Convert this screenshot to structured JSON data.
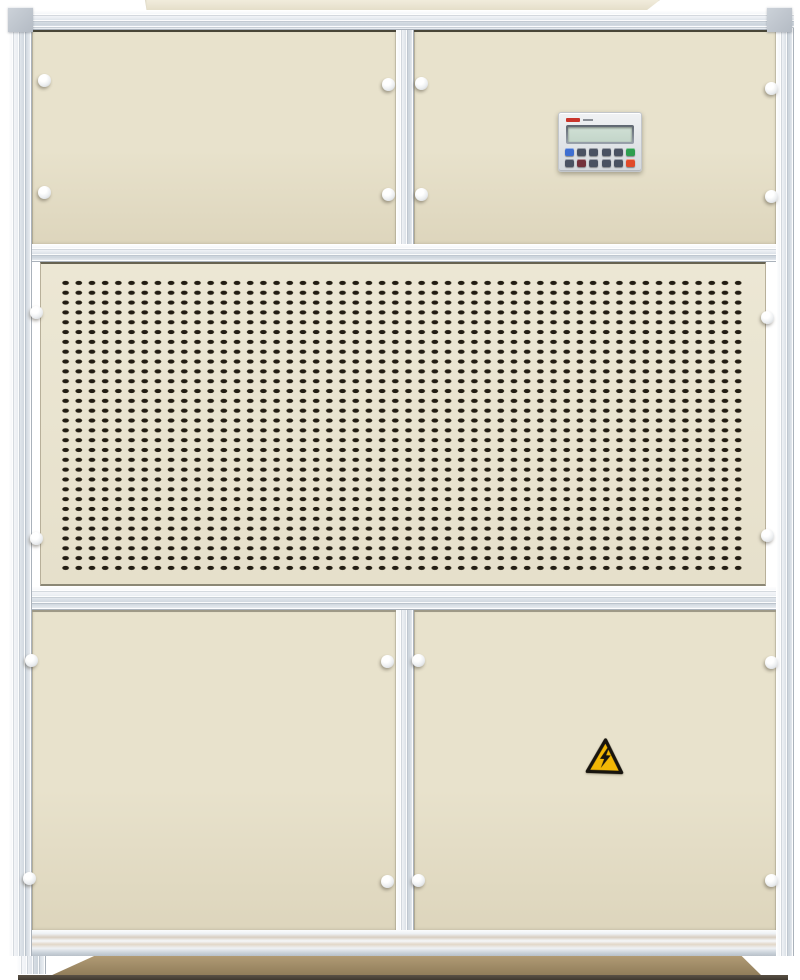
{
  "scene": {
    "alt": "Industrial cream-colored air handling cabinet with aluminum frame, controller keypad, ventilation grille and high-voltage warning label"
  },
  "colors": {
    "background": "#ffffff",
    "panel_cream": "#e8e2cc",
    "panel_cream_dark": "#ddd5bc",
    "frame_silver": "#dde3ea",
    "slot_dark": "#211c13",
    "plinth_tan": "#b29c76",
    "base_shadow": "#3f3930",
    "warning_yellow": "#f2b705",
    "warning_black": "#17140e"
  },
  "controller": {
    "brand_mark_color": "#c9352b",
    "brand_submark_color": "#8a8f96",
    "lcd_frame_color": "#9aa2ac",
    "lcd_screen_color": "#c3d5c9",
    "button_rows": [
      [
        "#3f6fd1",
        "#4a5262",
        "#4a5262",
        "#4a5262",
        "#4a5262",
        "#2e9e4f"
      ],
      [
        "#4a5262",
        "#74323c",
        "#4a5262",
        "#4a5262",
        "#4a5262",
        "#e04a2a"
      ]
    ]
  },
  "grille": {
    "columns": 52,
    "rows": 30,
    "slot_shape": "rounded-slot"
  },
  "icons": {
    "hazard_label": "high-voltage-warning-icon"
  }
}
